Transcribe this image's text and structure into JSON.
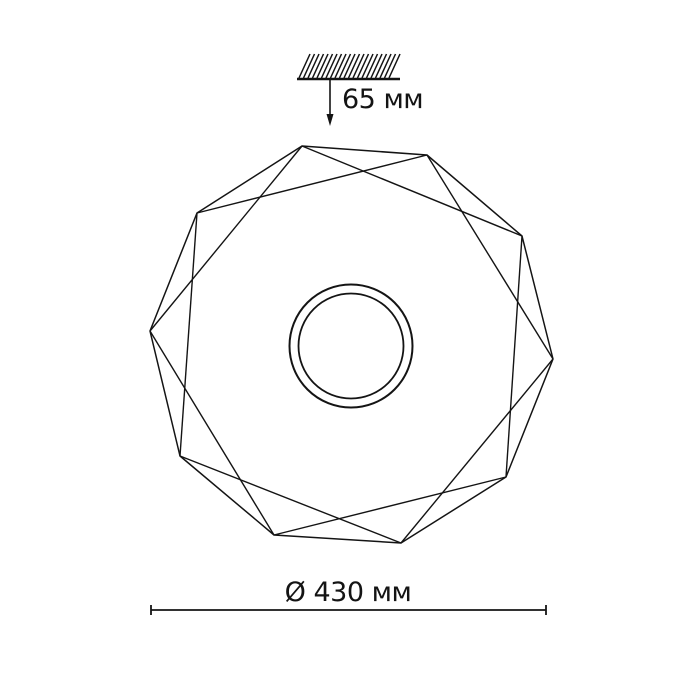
{
  "page": {
    "background_color": "#ffffff",
    "line_color": "#141414"
  },
  "annotations": {
    "offset_label": "65 мм",
    "offset_value_mm": 65,
    "diameter_label": "Ø 430 мм",
    "diameter_value_mm": 430,
    "units": "мм"
  },
  "figure": {
    "type": "technical-line-drawing",
    "subject": "round faceted ceiling lamp, front view, mounted 65 mm below ceiling",
    "stroke_color": "#141414",
    "center": [
      351,
      346
    ],
    "outline_vertices": [
      [
        150,
        331
      ],
      [
        197,
        213
      ],
      [
        302,
        146
      ],
      [
        427,
        155
      ],
      [
        522,
        236
      ],
      [
        553,
        359
      ],
      [
        506,
        477
      ],
      [
        401,
        543
      ],
      [
        274,
        535
      ],
      [
        180,
        456
      ]
    ],
    "facet_chords": [
      [
        0,
        2
      ],
      [
        1,
        3
      ],
      [
        2,
        4
      ],
      [
        3,
        5
      ],
      [
        4,
        6
      ],
      [
        5,
        7
      ],
      [
        6,
        8
      ],
      [
        7,
        9
      ],
      [
        8,
        0
      ],
      [
        9,
        1
      ]
    ],
    "circles": [
      {
        "cx": 351,
        "cy": 346,
        "r": 61.5,
        "w": 2.0
      },
      {
        "cx": 351,
        "cy": 346,
        "r": 52.5,
        "w": 1.8
      }
    ],
    "ceiling": {
      "x1": 297,
      "x2": 400,
      "y": 79,
      "tick_x0": 299,
      "tick_step": 4.5,
      "tick_count": 21,
      "tick_dx": 11,
      "tick_dy": -24
    },
    "arrow": {
      "x": 330,
      "y1": 80,
      "y2": 126
    },
    "dimension_line": {
      "x1": 151,
      "x2": 546,
      "y": 610,
      "tick": 5
    }
  }
}
